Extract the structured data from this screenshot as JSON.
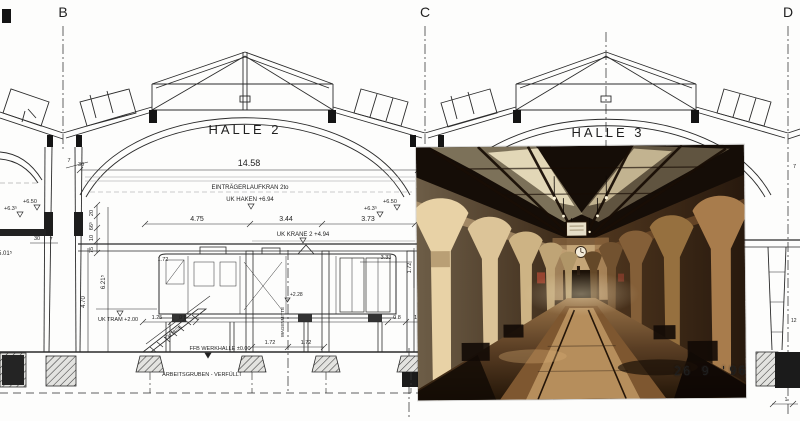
{
  "drawing": {
    "grid": {
      "b": "B",
      "c": "C",
      "d": "D"
    },
    "halls": {
      "halle2": "HALLE 2",
      "halle3": "HALLE 3"
    },
    "top_dims": {
      "span": "14.58",
      "bay1": "4.75",
      "bay2": "3.44",
      "bay3": "3.73"
    },
    "crane": {
      "label": "EINTRÄGERLAUFKRAN 2to",
      "uk_haken": "UK HAKEN   +6.94",
      "uk_krane": "UK KRANE 2   +4.94"
    },
    "levels": {
      "l635_left": "+6.3⁵",
      "l650_left": "+6.50",
      "l635_right": "+6.3⁵",
      "l650_right": "+6.50",
      "uk_tram": "UK TRAM  +2.00",
      "ffb": "FFB WERKHALLE ±0.00",
      "l228": "+2.28"
    },
    "left_dims": {
      "d7_top": "7",
      "d30_top": "30",
      "d30_col": "30",
      "d7_col": "7",
      "d20": "20",
      "d665": "66⁵",
      "d10": "10",
      "d75": "75",
      "d470": "4.70",
      "d6215": "6.21⁵",
      "d5015": "5.01⁵"
    },
    "lower_dims": {
      "d125": "1.25",
      "d08_left": "0.8",
      "d172_cab": "1.72",
      "d172_a": "1.72",
      "d172_b": "1.72",
      "d08_right": "0.8",
      "d12": "1.2",
      "d333": "3.33",
      "d172_right": "1.72"
    },
    "stairs_label": "13x18/26",
    "axis_label": "WAGENMITTE",
    "pit_label": "ARBEITSGRUBEN  -  VERFÜLLT",
    "right_dims": {
      "d7": "7",
      "d12": "12",
      "d1": "1"
    }
  },
  "photo": {
    "date_stamp": "26 9 '96"
  }
}
